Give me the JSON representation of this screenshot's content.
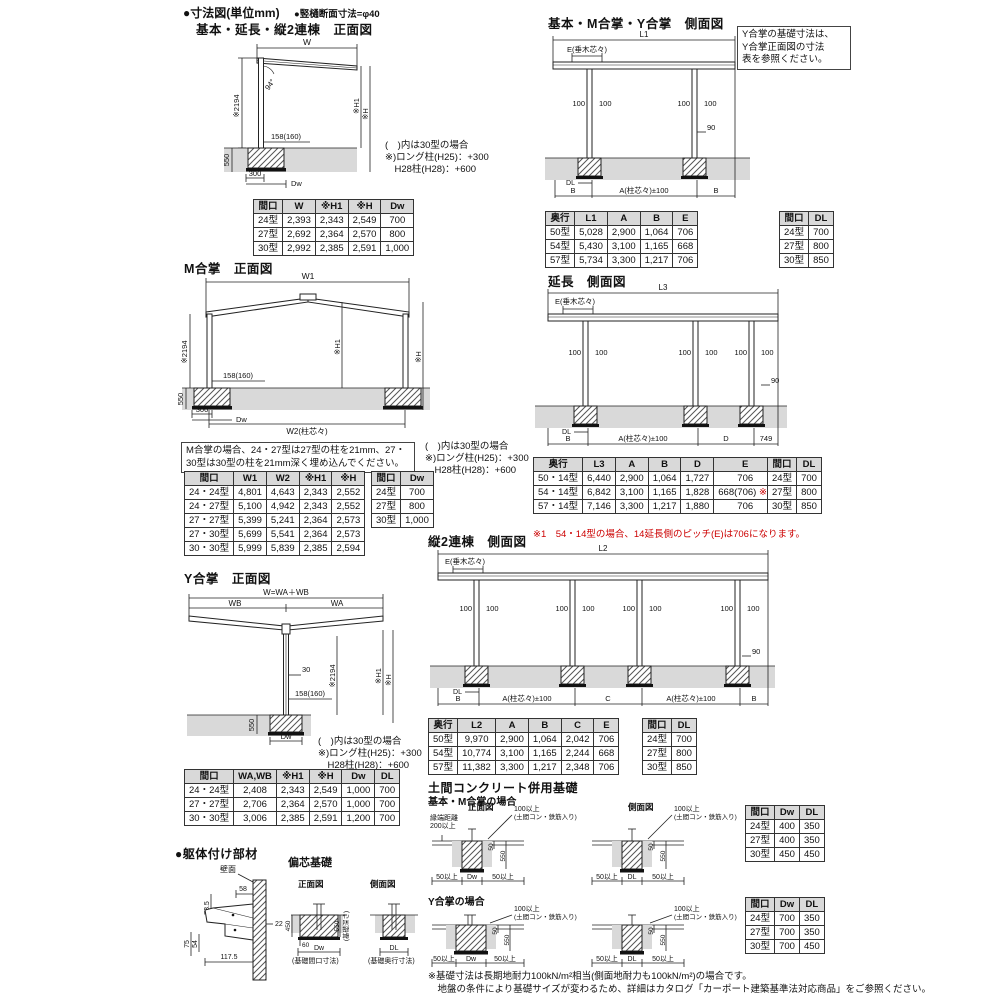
{
  "colors": {
    "accent_red": "#cc0000",
    "ground_gray": "#d9d9d9",
    "table_header_gray": "#d9d9d9"
  },
  "header": {
    "title": "●寸法図(単位mm)",
    "subtitle": "●竪樋断面寸法=φ40"
  },
  "front_basic": {
    "title": "基本・延長・縦2連棟　正面図",
    "dims": {
      "w": "W",
      "angle": "94°",
      "h2194": "※2194",
      "beam": "158(160)",
      "h1": "※H1",
      "h": "※H",
      "depth": "550",
      "w300": "300",
      "dw": "Dw"
    },
    "note": [
      "(　)内は30型の場合",
      "※)ロング柱(H25)：+300",
      "　H28柱(H28)：+600"
    ],
    "table": {
      "headers": [
        "間口",
        "W",
        "※H1",
        "※H",
        "Dw"
      ],
      "rows": [
        [
          "24型",
          "2,393",
          "2,343",
          "2,549",
          "700"
        ],
        [
          "27型",
          "2,692",
          "2,364",
          "2,570",
          "800"
        ],
        [
          "30型",
          "2,992",
          "2,385",
          "2,591",
          "1,000"
        ]
      ]
    }
  },
  "m_gassho": {
    "title": "M合掌　正面図",
    "dims": {
      "w1": "W1",
      "w2": "W2(柱芯々)",
      "h2194": "※2194",
      "beam": "158(160)",
      "h1": "※H1",
      "h": "※H",
      "depth": "550",
      "w300": "300",
      "dw": "Dw"
    },
    "note_box": "M合掌の場合、24・27型は27型の柱を21mm、27・30型は30型の柱を21mm深く埋め込んでください。",
    "note": [
      "(　)内は30型の場合",
      "※)ロング柱(H25)：+300",
      "　H28柱(H28)：+600"
    ],
    "table": {
      "headers": [
        "間口",
        "W1",
        "W2",
        "※H1",
        "※H"
      ],
      "rows": [
        [
          "24・24型",
          "4,801",
          "4,643",
          "2,343",
          "2,552"
        ],
        [
          "24・27型",
          "5,100",
          "4,942",
          "2,343",
          "2,552"
        ],
        [
          "27・27型",
          "5,399",
          "5,241",
          "2,364",
          "2,573"
        ],
        [
          "27・30型",
          "5,699",
          "5,541",
          "2,364",
          "2,573"
        ],
        [
          "30・30型",
          "5,999",
          "5,839",
          "2,385",
          "2,594"
        ]
      ]
    },
    "table_dw": {
      "headers": [
        "間口",
        "Dw"
      ],
      "rows": [
        [
          "24型",
          "700"
        ],
        [
          "27型",
          "800"
        ],
        [
          "30型",
          "1,000"
        ]
      ]
    }
  },
  "y_gassho": {
    "title": "Y合掌　正面図",
    "dims": {
      "w": "W=WA＋WB",
      "wb": "WB",
      "wa": "WA",
      "p30": "30",
      "h2194": "※2194",
      "h1": "※H1",
      "h": "※H",
      "beam": "158(160)",
      "depth": "550",
      "dw": "Dw"
    },
    "note": [
      "(　)内は30型の場合",
      "※)ロング柱(H25)：+300",
      "　H28柱(H28)：+600"
    ],
    "table": {
      "headers": [
        "間口",
        "WA,WB",
        "※H1",
        "※H",
        "Dw",
        "DL"
      ],
      "rows": [
        [
          "24・24型",
          "2,408",
          "2,343",
          "2,549",
          "1,000",
          "700"
        ],
        [
          "27・27型",
          "2,706",
          "2,364",
          "2,570",
          "1,000",
          "700"
        ],
        [
          "30・30型",
          "3,006",
          "2,385",
          "2,591",
          "1,200",
          "700"
        ]
      ]
    }
  },
  "side_basic": {
    "title": "基本・M合掌・Y合掌　側面図",
    "note_box": [
      "Y合掌の基礎寸法は、",
      "Y合掌正面図の寸法",
      "表を参照ください。"
    ],
    "dims": {
      "l1": "L1",
      "e": "E(垂木芯々)",
      "p100": "100",
      "p90": "90",
      "dl": "DL",
      "b": "B",
      "a": "A(柱芯々)±100"
    },
    "table": {
      "headers": [
        "奥行",
        "L1",
        "A",
        "B",
        "E"
      ],
      "rows": [
        [
          "50型",
          "5,028",
          "2,900",
          "1,064",
          "706"
        ],
        [
          "54型",
          "5,430",
          "3,100",
          "1,165",
          "668"
        ],
        [
          "57型",
          "5,734",
          "3,300",
          "1,217",
          "706"
        ]
      ]
    },
    "table_dl": {
      "headers": [
        "間口",
        "DL"
      ],
      "rows": [
        [
          "24型",
          "700"
        ],
        [
          "27型",
          "800"
        ],
        [
          "30型",
          "850"
        ]
      ]
    }
  },
  "side_ext": {
    "title": "延長　側面図",
    "dims": {
      "l3": "L3",
      "e": "E(垂木芯々)",
      "p100": "100",
      "p90": "90",
      "dl": "DL",
      "b": "B",
      "a": "A(柱芯々)±100",
      "d": "D",
      "p749": "749"
    },
    "table": {
      "headers": [
        "奥行",
        "L3",
        "A",
        "B",
        "D",
        "E"
      ],
      "rows": [
        [
          "50・14型",
          "6,440",
          "2,900",
          "1,064",
          "1,727",
          "706"
        ],
        [
          "54・14型",
          "6,842",
          "3,100",
          "1,165",
          "1,828",
          "668(706) ※1"
        ],
        [
          "57・14型",
          "7,146",
          "3,300",
          "1,217",
          "1,880",
          "706"
        ]
      ]
    },
    "table_dl": {
      "headers": [
        "間口",
        "DL"
      ],
      "rows": [
        [
          "24型",
          "700"
        ],
        [
          "27型",
          "800"
        ],
        [
          "30型",
          "850"
        ]
      ]
    },
    "note_red": "※1　54・14型の場合、14延長側のピッチ(E)は706になります。"
  },
  "side_double": {
    "title": "縦2連棟　側面図",
    "dims": {
      "l2": "L2",
      "e": "E(垂木芯々)",
      "p100": "100",
      "p90": "90",
      "dl": "DL",
      "b": "B",
      "a": "A(柱芯々)±100",
      "c": "C"
    },
    "table": {
      "headers": [
        "奥行",
        "L2",
        "A",
        "B",
        "C",
        "E"
      ],
      "rows": [
        [
          "50型",
          "9,970",
          "2,900",
          "1,064",
          "2,042",
          "706"
        ],
        [
          "54型",
          "10,774",
          "3,100",
          "1,165",
          "2,244",
          "668"
        ],
        [
          "57型",
          "11,382",
          "3,300",
          "1,217",
          "2,348",
          "706"
        ]
      ]
    },
    "table_dl": {
      "headers": [
        "間口",
        "DL"
      ],
      "rows": [
        [
          "24型",
          "700"
        ],
        [
          "27型",
          "800"
        ],
        [
          "30型",
          "850"
        ]
      ]
    }
  },
  "doma": {
    "title": "土間コンクリート併用基礎",
    "labels": {
      "front": "正面図",
      "side": "側面図",
      "edge1": "縁端距離",
      "edge2": "200以上",
      "conc1": "100以上",
      "conc2": "(土間コン・鉄筋入り)",
      "p50": "50",
      "p550": "550",
      "min50": "50以上",
      "dw": "Dw",
      "dl": "DL"
    },
    "case_basic": {
      "label": "基本・M合掌の場合",
      "table": {
        "headers": [
          "間口",
          "Dw",
          "DL"
        ],
        "rows": [
          [
            "24型",
            "400",
            "350"
          ],
          [
            "27型",
            "400",
            "350"
          ],
          [
            "30型",
            "450",
            "450"
          ]
        ]
      }
    },
    "case_y": {
      "label": "Y合掌の場合",
      "table": {
        "headers": [
          "間口",
          "Dw",
          "DL"
        ],
        "rows": [
          [
            "24型",
            "700",
            "350"
          ],
          [
            "27型",
            "700",
            "350"
          ],
          [
            "30型",
            "700",
            "450"
          ]
        ]
      }
    }
  },
  "kutai": {
    "title": "●躯体付け部材",
    "dims": {
      "wall": "壁面",
      "d58": "58",
      "d735": "73.5",
      "d22": "22",
      "d75": "75",
      "d54": "54",
      "d1175": "117.5"
    }
  },
  "henshin": {
    "title": "偏芯基礎",
    "front": "正面図",
    "side": "側面図",
    "d450": "450",
    "d550": "550",
    "depth_note": "(基礎深さ)",
    "d60": "60",
    "dw": "Dw",
    "dl": "DL",
    "cap_front": "(基礎間口寸法)",
    "cap_side": "(基礎奥行寸法)"
  },
  "footer": {
    "lines": [
      "※基礎寸法は長期地耐力100kN/m²相当(側面地耐力も100kN/m²)の場合です。",
      "　地盤の条件により基礎サイズが変わるため、詳細はカタログ「カーポート建築基準法対応商品」をご参照ください。"
    ]
  }
}
